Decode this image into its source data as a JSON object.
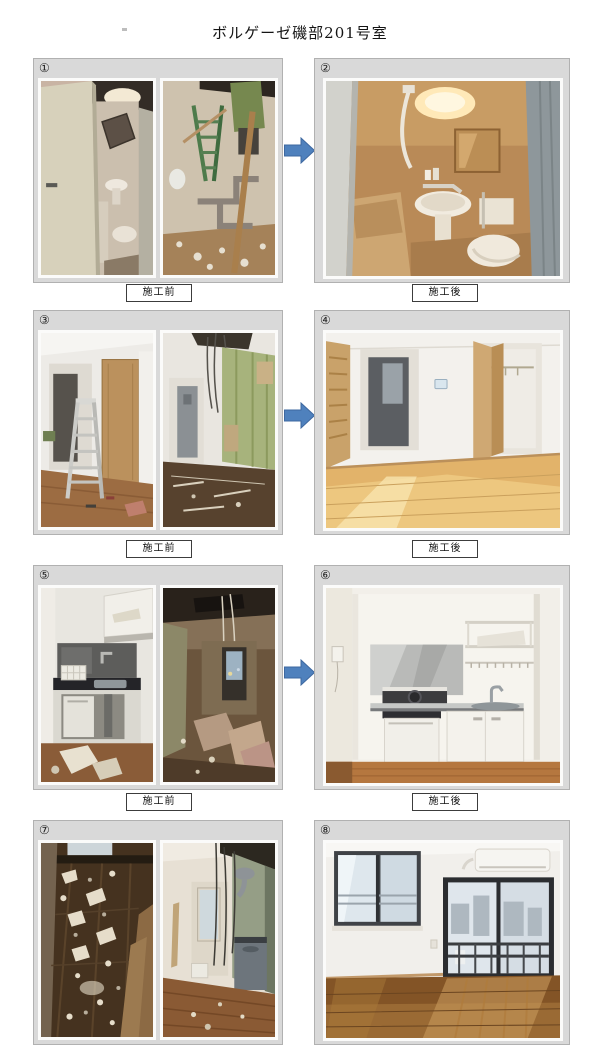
{
  "page": {
    "title": "ボルゲーゼ磯部201号室"
  },
  "captions": {
    "before": "施工前",
    "after": "施工後"
  },
  "rows": [
    {
      "left_number": "①",
      "right_number": "②",
      "caption_before": "施工前",
      "caption_after": "施工後",
      "left_photos": [
        "bathroom-before-open-door",
        "bathroom-demolition-ladder-pipes"
      ],
      "right_photo": "bathroom-after-renovation",
      "has_arrow": true
    },
    {
      "left_number": "③",
      "right_number": "④",
      "caption_before": "施工前",
      "caption_after": "施工後",
      "left_photos": [
        "hallway-with-stepladder",
        "wall-demolition-green-insulation"
      ],
      "right_photo": "empty-room-after-wood-floor",
      "has_arrow": true
    },
    {
      "left_number": "⑤",
      "right_number": "⑥",
      "caption_before": "施工前",
      "caption_after": "施工後",
      "left_photos": [
        "old-kitchen-before",
        "dark-room-demolition"
      ],
      "right_photo": "new-kitchen-after",
      "has_arrow": true
    },
    {
      "left_number": "⑦",
      "right_number": "⑧",
      "left_photos": [
        "floor-covered-in-debris",
        "hallway-demolition-hanging-wires"
      ],
      "right_photo": "living-room-after",
      "has_arrow": false
    }
  ],
  "arrow_icon": {
    "direction": "right",
    "fill": "#4f81bd",
    "stroke": "#3e68a0"
  },
  "colors": {
    "page_bg": "#ffffff",
    "panel_bg": "#d9d9d9",
    "panel_border": "#b1b1b1",
    "caption_border": "#3c3c3c"
  }
}
